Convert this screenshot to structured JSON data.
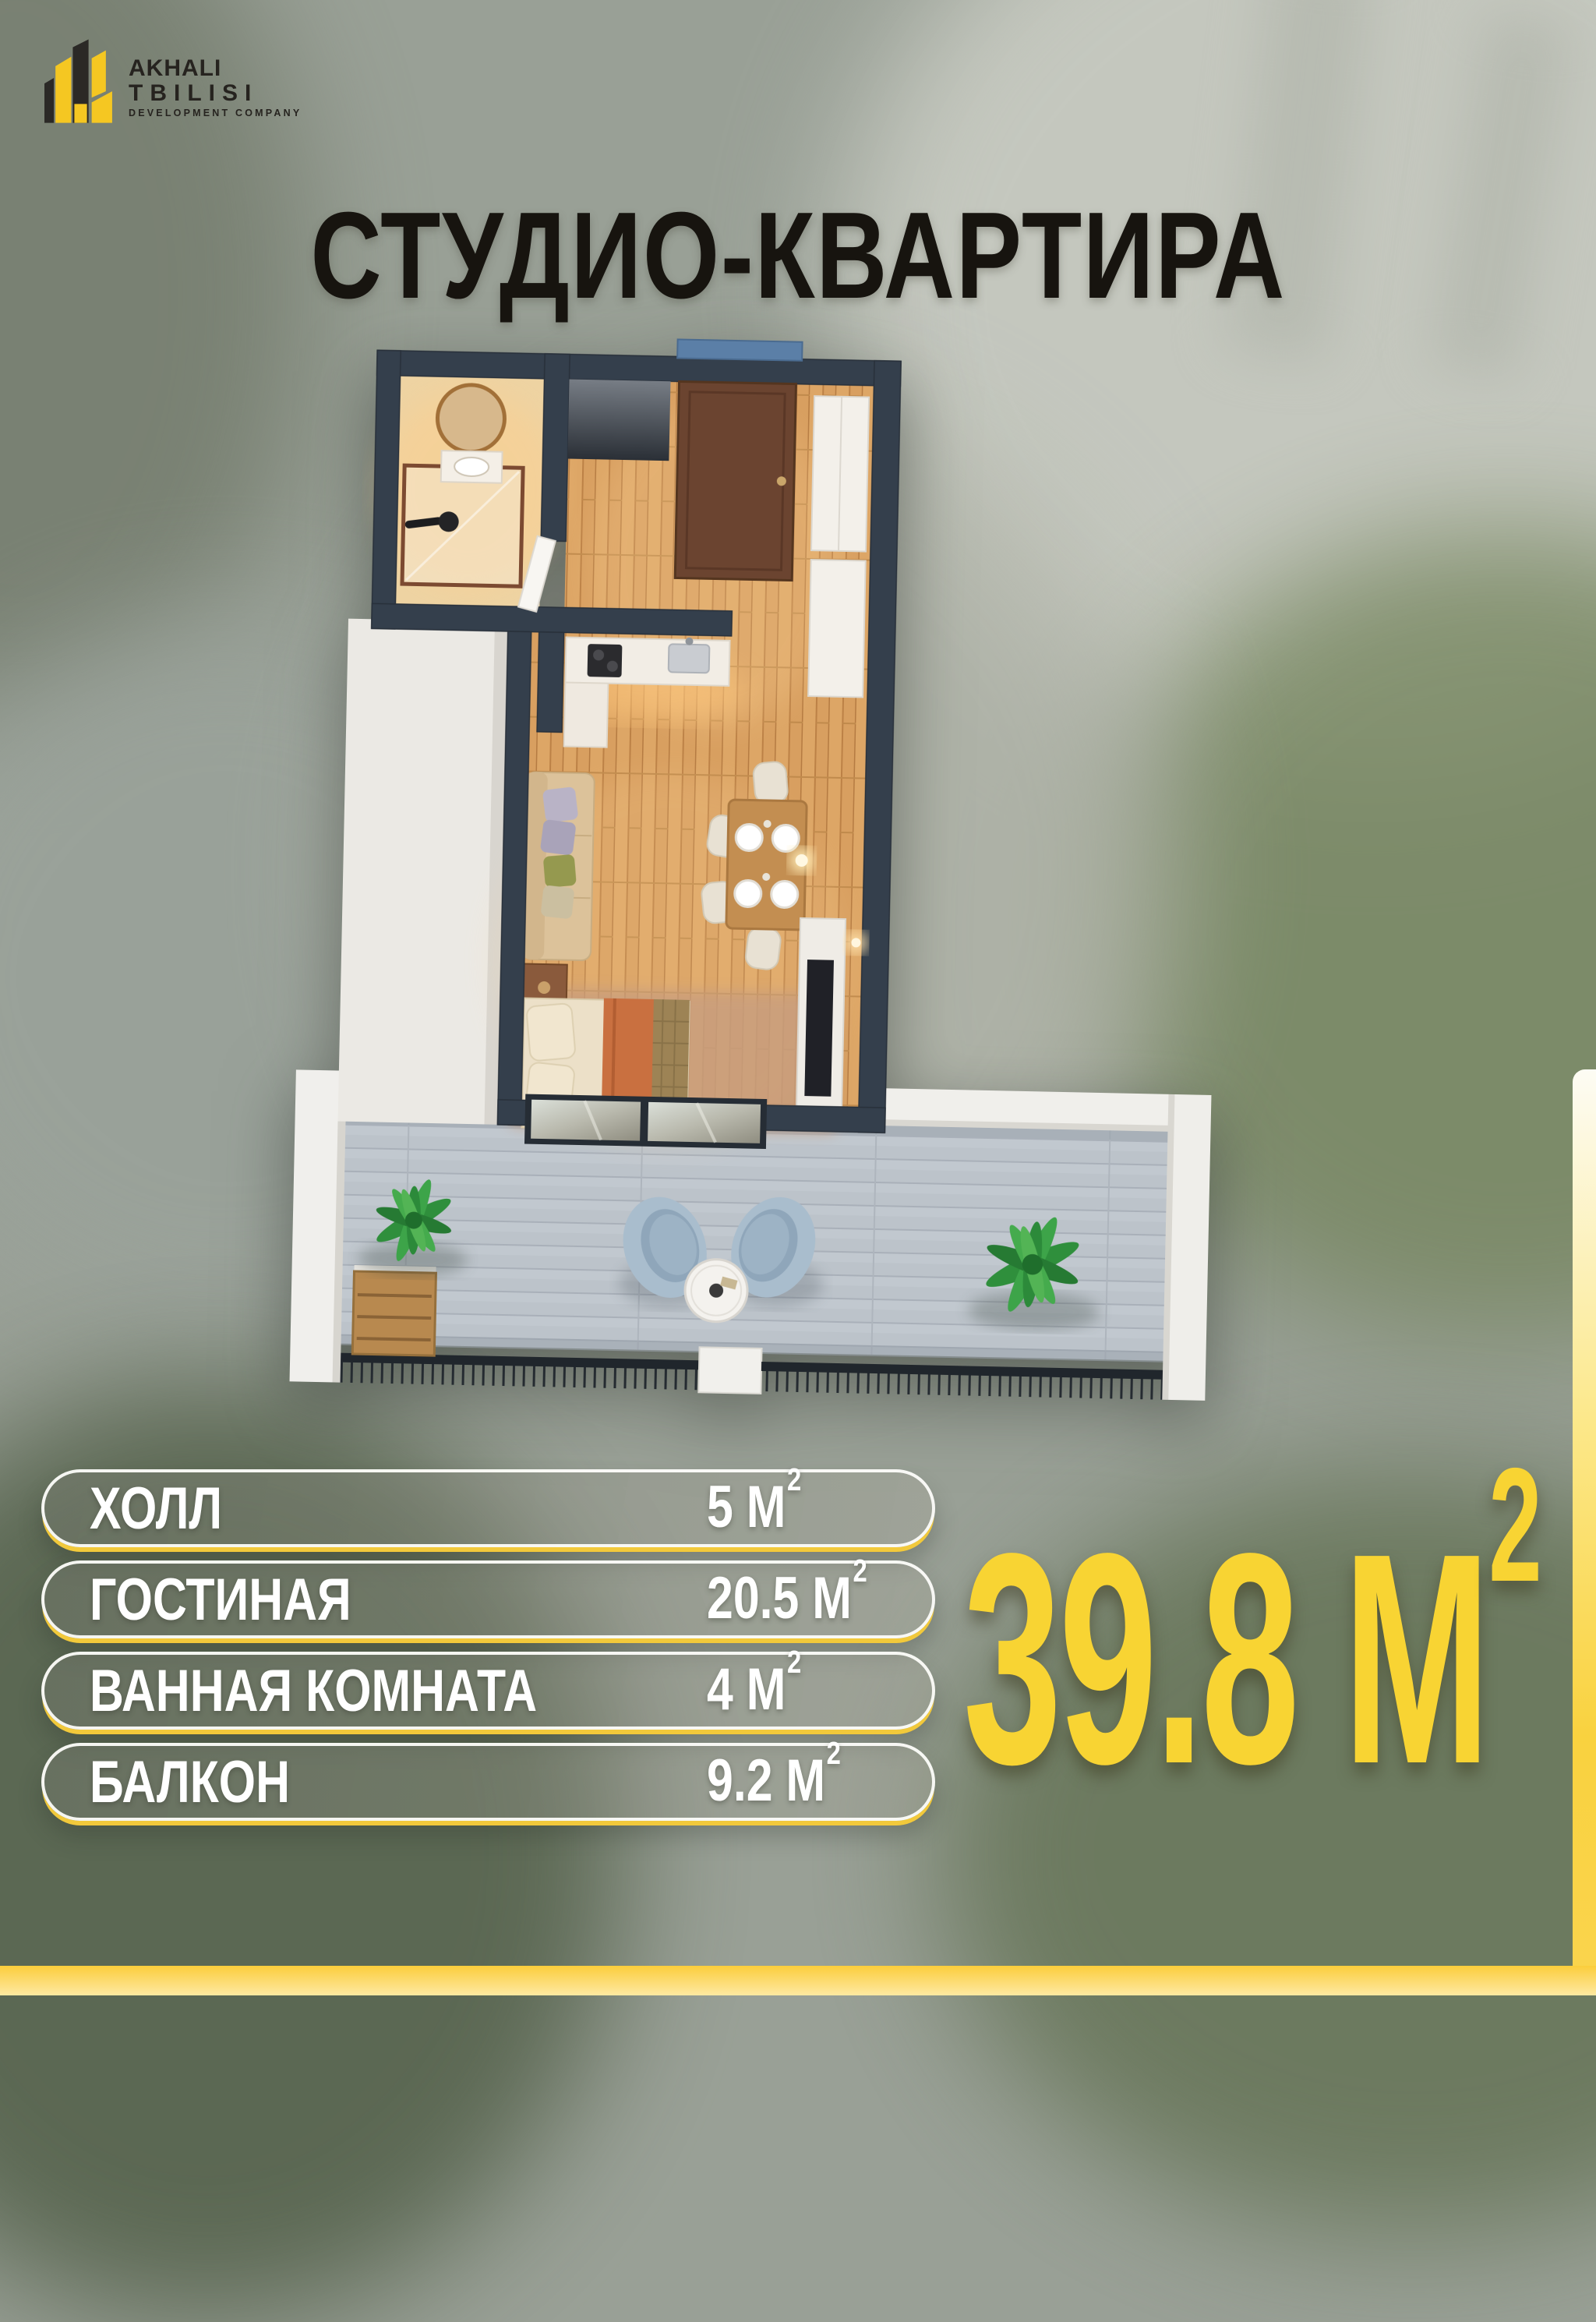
{
  "brand": {
    "name_line1": "AKHALI",
    "name_line2": "TBILISI",
    "tagline": "DEVELOPMENT COMPANY"
  },
  "title": "СТУДИО-КВАРТИРА",
  "rooms": [
    {
      "name": "ХОЛЛ",
      "area": "5 М",
      "sup": "2"
    },
    {
      "name": "ГОСТИНАЯ",
      "area": "20.5 М",
      "sup": "2"
    },
    {
      "name": "ВАННАЯ КОМНАТА",
      "area": "4 М",
      "sup": "2"
    },
    {
      "name": "БАЛКОН",
      "area": "9.2 М",
      "sup": "2"
    }
  ],
  "total_area": {
    "value": "39.8 М",
    "sup": "2"
  },
  "colors": {
    "accent_yellow": "#F8D433",
    "logo_yellow": "#F5C722",
    "logo_dark": "#2B2926",
    "title_dark": "#17140F",
    "wall_dark": "#343F4C",
    "entry_door_brown": "#6B4430",
    "door_lintel_blue": "#5B7FA7",
    "wood_floor": "#D89F60",
    "balcony_tile": "#BCC3CA",
    "pill_border_white": "#FDFDFA",
    "pill_underline_yellow": "#F2C93B",
    "footer_top": "#FBCD3C",
    "footer_bottom": "#FEE9A2"
  }
}
